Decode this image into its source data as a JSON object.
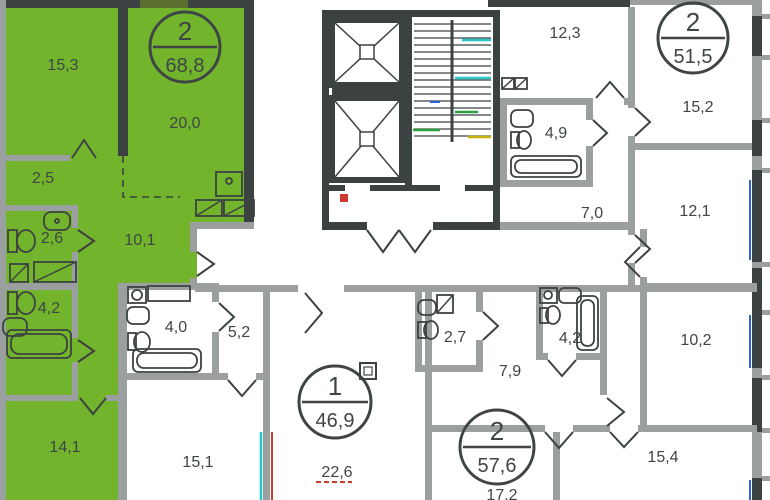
{
  "plan_title": "floor-plan",
  "colors": {
    "highlight": "#72b42c",
    "wall_dark": "#3c4242",
    "wall_light": "#9b9f9f",
    "window_green": "#5c7030",
    "text": "#3f4546",
    "riser_cyan": "#29c4c6",
    "riser_green": "#2e9e3f",
    "riser_yellow": "#c8b400",
    "riser_blue": "#2a62d8",
    "riser_red": "#cc3b2f"
  },
  "badges": [
    {
      "apartment": "highlighted-left",
      "rooms": "2",
      "area": "68,8"
    },
    {
      "apartment": "top-right",
      "rooms": "2",
      "area": "51,5"
    },
    {
      "apartment": "center-bottom",
      "rooms": "1",
      "area": "46,9"
    },
    {
      "apartment": "bottom-right",
      "rooms": "2",
      "area": "57,6"
    }
  ],
  "labels": {
    "green_living": "15,3",
    "green_kitchen_living": "20,0",
    "green_hall": "2,5",
    "green_wc": "2,6",
    "green_corridor": "10,1",
    "green_bath": "4,2",
    "green_bedroom": "14,1",
    "apt_center_bath": "4,0",
    "apt_center_hall": "5,2",
    "apt_center_bedroom": "15,1",
    "apt_center_living": "22,6",
    "apt_right_wc": "2,7",
    "apt_right_hall": "7,9",
    "apt_right_bath": "4,2",
    "apt_right_room1": "10,2",
    "apt_right_room2": "15,4",
    "apt_right_living": "17,2",
    "apt_top_room1": "12,3",
    "apt_top_bath": "4,9",
    "apt_top_hall": "7,0",
    "apt_top_room2": "15,2",
    "apt_top_room3": "12,1"
  }
}
